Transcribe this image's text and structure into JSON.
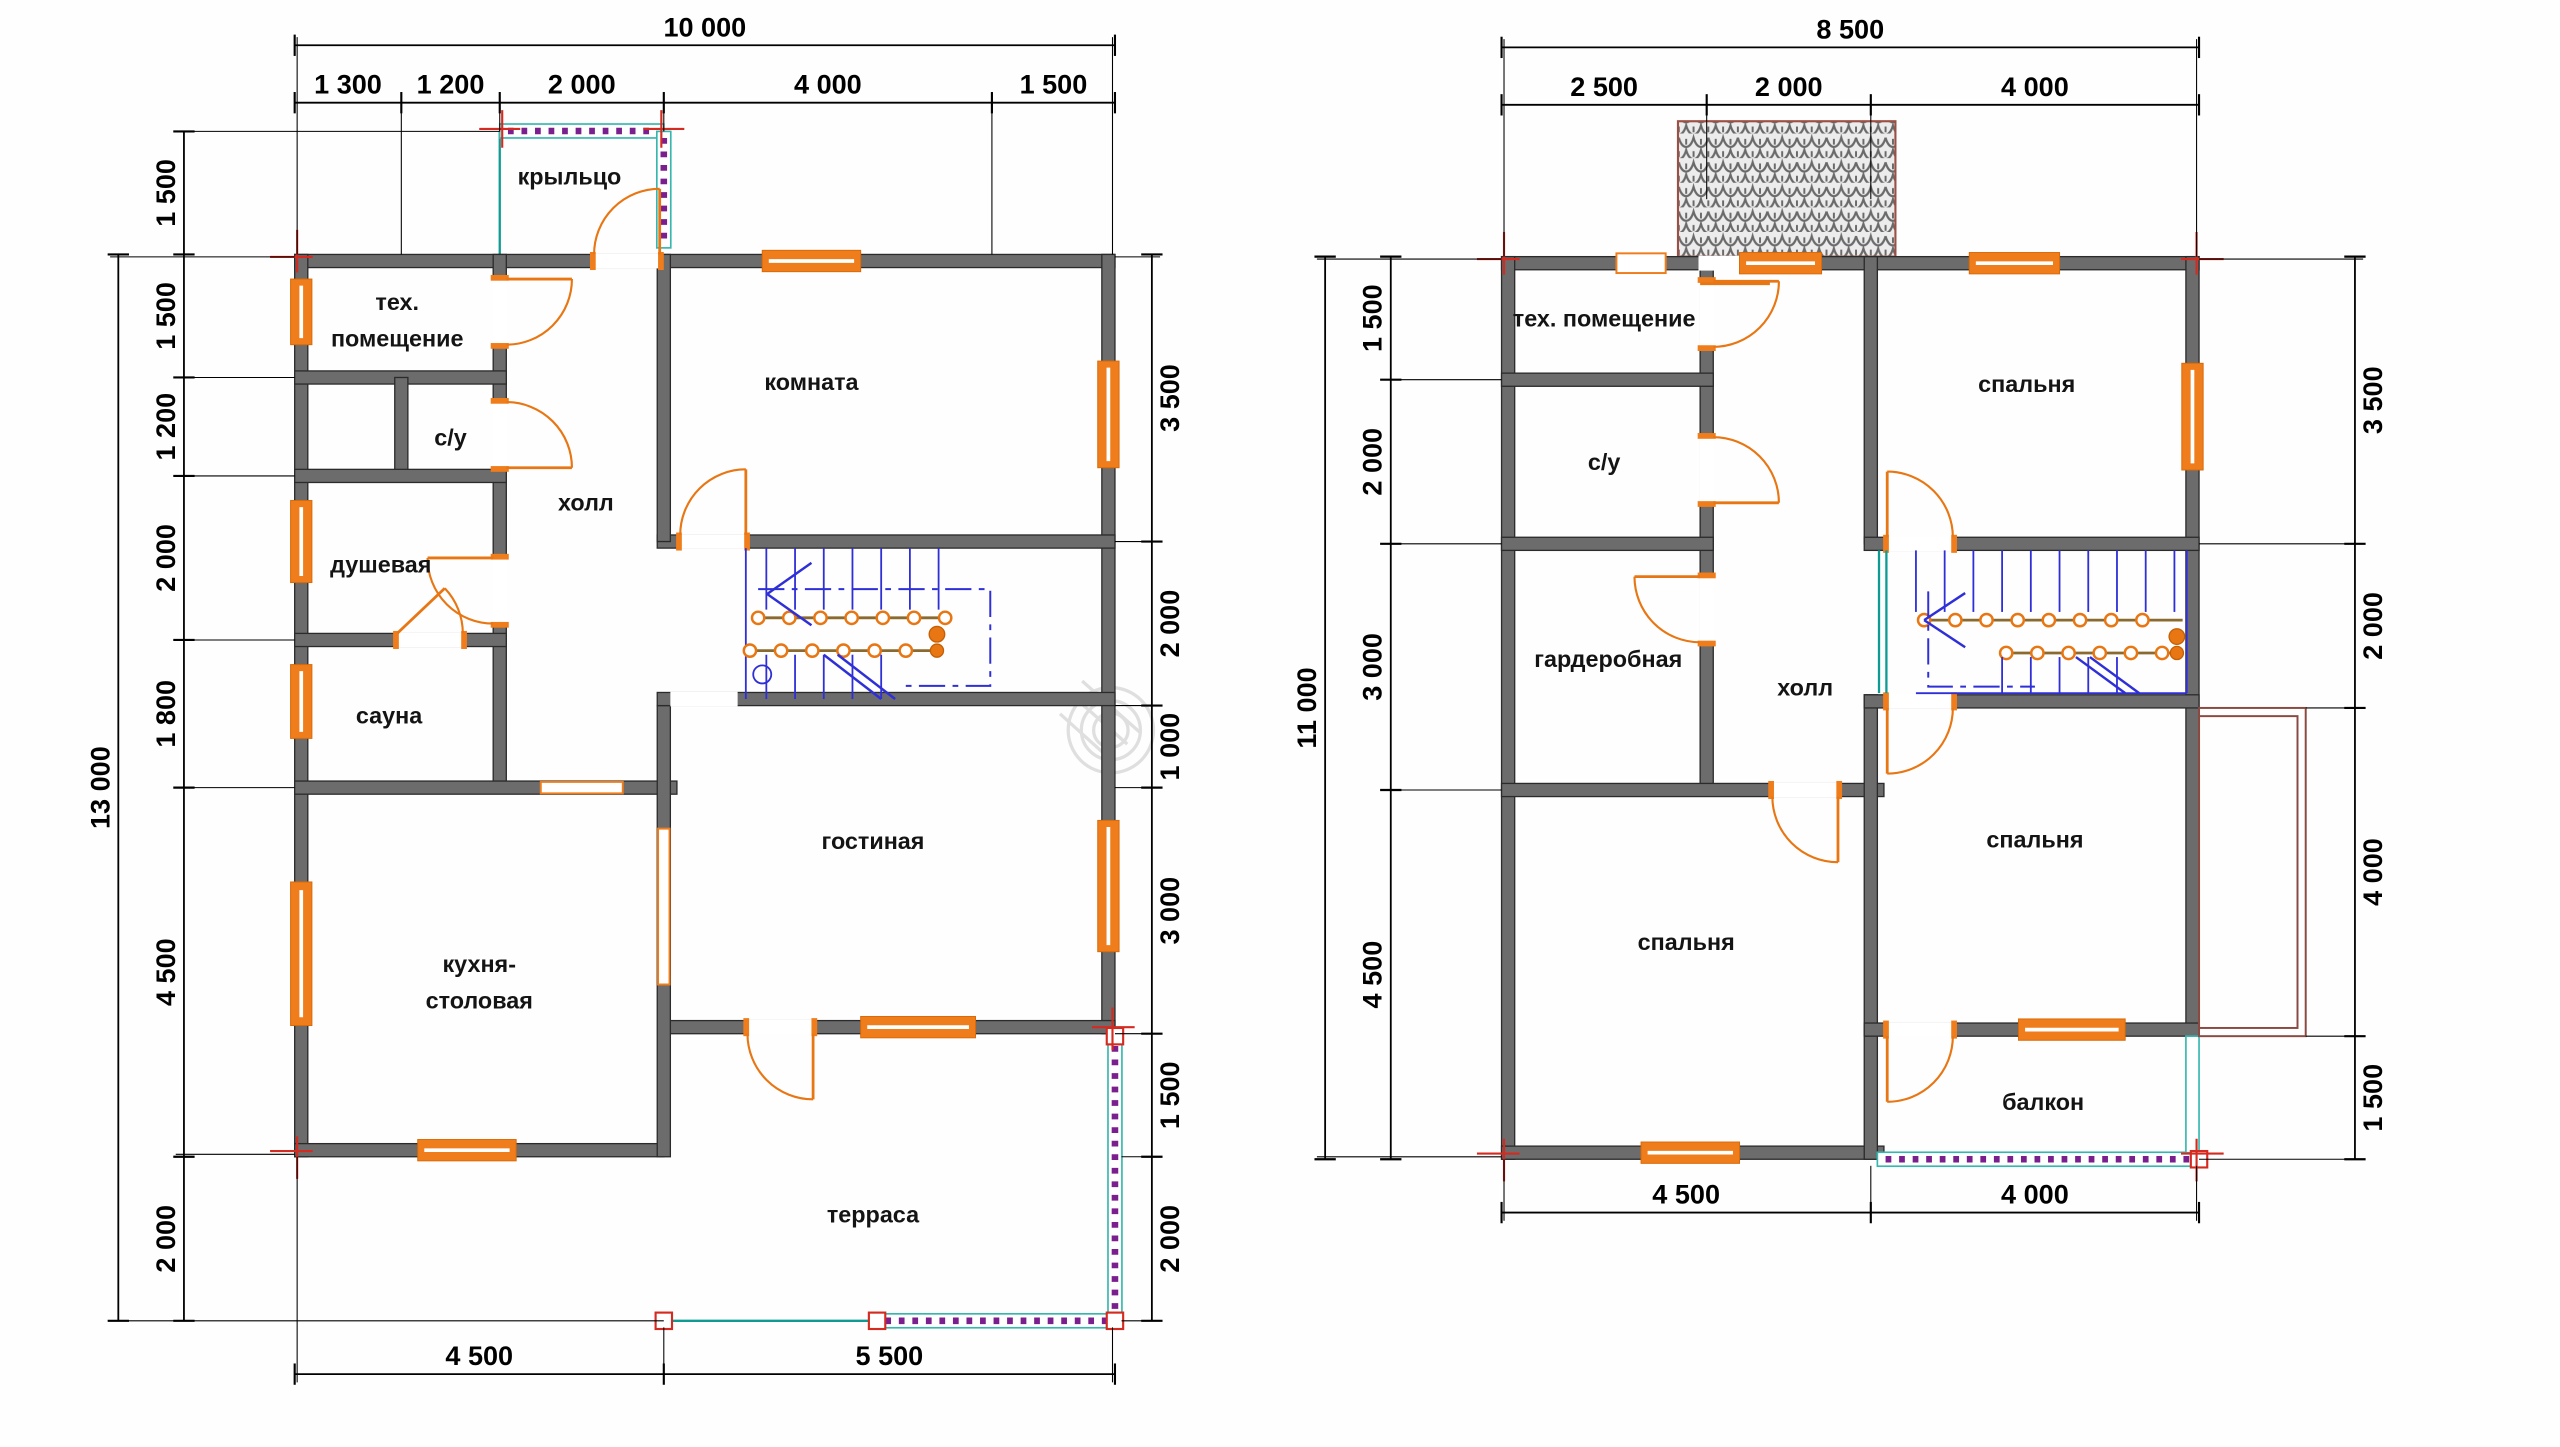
{
  "plan1": {
    "dims": {
      "top_total": "10 000",
      "top": [
        "1 300",
        "1 200",
        "2 000",
        "4 000",
        "1 500"
      ],
      "left_total": "13 000",
      "left": [
        "1 500",
        "1 500",
        "1 200",
        "2 000",
        "1 800",
        "4 500",
        "2 000"
      ],
      "right": [
        "3 500",
        "2 000",
        "1 000",
        "3 000",
        "1 500",
        "2 000"
      ],
      "bottom": [
        "4 500",
        "5 500"
      ]
    },
    "rooms": {
      "porch": "крыльцо",
      "tech_line1": "тех.",
      "tech_line2": "помещение",
      "wc": "с/у",
      "shower": "душевая",
      "sauna": "сауна",
      "kitchen_line1": "кухня-",
      "kitchen_line2": "столовая",
      "hall": "холл",
      "room": "комната",
      "living": "гостиная",
      "terrace": "терраса"
    }
  },
  "plan2": {
    "dims": {
      "top_total": "8 500",
      "top": [
        "2 500",
        "2 000",
        "4 000"
      ],
      "left_total": "11 000",
      "left": [
        "1 500",
        "2 000",
        "3 000",
        "4 500"
      ],
      "right": [
        "3 500",
        "2 000",
        "4 000",
        "1 500"
      ],
      "bottom": [
        "4 500",
        "4 000"
      ]
    },
    "rooms": {
      "tech": "тех. помещение",
      "wc": "с/у",
      "wardrobe": "гардеробная",
      "hall": "холл",
      "bedroom_top": "спальня",
      "bedroom_left": "спальня",
      "bedroom_right": "спальня",
      "balcony": "балкон"
    }
  },
  "colors": {
    "wall": "#6c6c6c",
    "accent_orange": "#f07d1b",
    "stairs_blue": "#2f2fd8",
    "railing_teal": "#35b6ae",
    "railing_purple": "#7a1f8e",
    "marker_red": "#d42a20",
    "roof_hatch_border": "#9c4f44"
  }
}
